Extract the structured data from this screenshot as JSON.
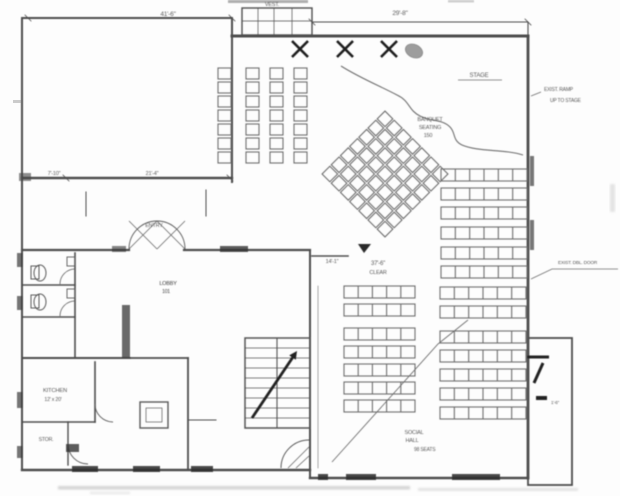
{
  "drawing": {
    "kind": "scanned floor plan",
    "paper_color": "#fdfdfd",
    "ink_color": "#5a5a5a",
    "dark_ink": "#202020"
  },
  "annotations": [
    {
      "name": "dim-top-left",
      "text": "41'-6\"",
      "x": 168,
      "y": 16,
      "size": 6.5,
      "align": "middle"
    },
    {
      "name": "dim-top-right",
      "text": "29'-8\"",
      "x": 400,
      "y": 15,
      "size": 6.5,
      "align": "middle"
    },
    {
      "name": "vestibule-label",
      "text": "VEST.",
      "x": 272,
      "y": 6,
      "size": 5.5,
      "align": "middle"
    },
    {
      "name": "stage-label",
      "text": "STAGE",
      "x": 479,
      "y": 77,
      "size": 6,
      "align": "middle"
    },
    {
      "name": "note-stage-right-1",
      "text": "EXIST. RAMP",
      "x": 544,
      "y": 91,
      "size": 5,
      "align": "start"
    },
    {
      "name": "note-stage-right-2",
      "text": "UP TO STAGE",
      "x": 550,
      "y": 102,
      "size": 5,
      "align": "start"
    },
    {
      "name": "seating-label-1",
      "text": "BANQUET",
      "x": 430,
      "y": 121,
      "size": 5.5,
      "align": "middle"
    },
    {
      "name": "seating-label-2",
      "text": "SEATING",
      "x": 430,
      "y": 129,
      "size": 5.5,
      "align": "middle"
    },
    {
      "name": "seating-label-3",
      "text": "150",
      "x": 428,
      "y": 137,
      "size": 5.5,
      "align": "middle"
    },
    {
      "name": "dim-left-wall-1",
      "text": "7'-10\"",
      "x": 54,
      "y": 175,
      "size": 5.5,
      "align": "middle"
    },
    {
      "name": "dim-left-wall-2",
      "text": "21'-4\"",
      "x": 152,
      "y": 175,
      "size": 5.5,
      "align": "middle"
    },
    {
      "name": "entry-label",
      "text": "ENTRY",
      "x": 154,
      "y": 227,
      "size": 5.5,
      "align": "middle"
    },
    {
      "name": "dim-hall-top",
      "text": "14'-1\"",
      "x": 332,
      "y": 263,
      "size": 5.5,
      "align": "middle"
    },
    {
      "name": "hall-clear-1",
      "text": "37'-6\"",
      "x": 378,
      "y": 265,
      "size": 6,
      "align": "middle"
    },
    {
      "name": "hall-clear-2",
      "text": "CLEAR",
      "x": 378,
      "y": 274,
      "size": 5.5,
      "align": "middle"
    },
    {
      "name": "note-door-right",
      "text": "EXIST. DBL. DOOR",
      "x": 558,
      "y": 264,
      "size": 4.8,
      "align": "start"
    },
    {
      "name": "lobby-label-1",
      "text": "LOBBY",
      "x": 168,
      "y": 285,
      "size": 5.5,
      "align": "middle",
      "color": "#3c3c3c"
    },
    {
      "name": "lobby-label-2",
      "text": "101",
      "x": 166,
      "y": 293,
      "size": 5,
      "align": "middle",
      "color": "#3c3c3c"
    },
    {
      "name": "kitchen-label-1",
      "text": "KITCHEN",
      "x": 55,
      "y": 392,
      "size": 5.8,
      "align": "middle"
    },
    {
      "name": "kitchen-label-2",
      "text": "12' x 20'",
      "x": 53,
      "y": 401,
      "size": 5.2,
      "align": "middle"
    },
    {
      "name": "storage-label",
      "text": "STOR.",
      "x": 46,
      "y": 441,
      "size": 5.2,
      "align": "middle"
    },
    {
      "name": "social-label-1",
      "text": "SOCIAL",
      "x": 414,
      "y": 434,
      "size": 5.5,
      "align": "middle"
    },
    {
      "name": "social-label-2",
      "text": "HALL",
      "x": 412,
      "y": 442,
      "size": 5.5,
      "align": "middle"
    },
    {
      "name": "social-label-3",
      "text": "98 SEATS",
      "x": 414,
      "y": 451,
      "size": 5
    },
    {
      "name": "ramp-note",
      "text": "1'-6\"",
      "x": 551,
      "y": 404,
      "size": 4.5,
      "align": "start"
    }
  ]
}
